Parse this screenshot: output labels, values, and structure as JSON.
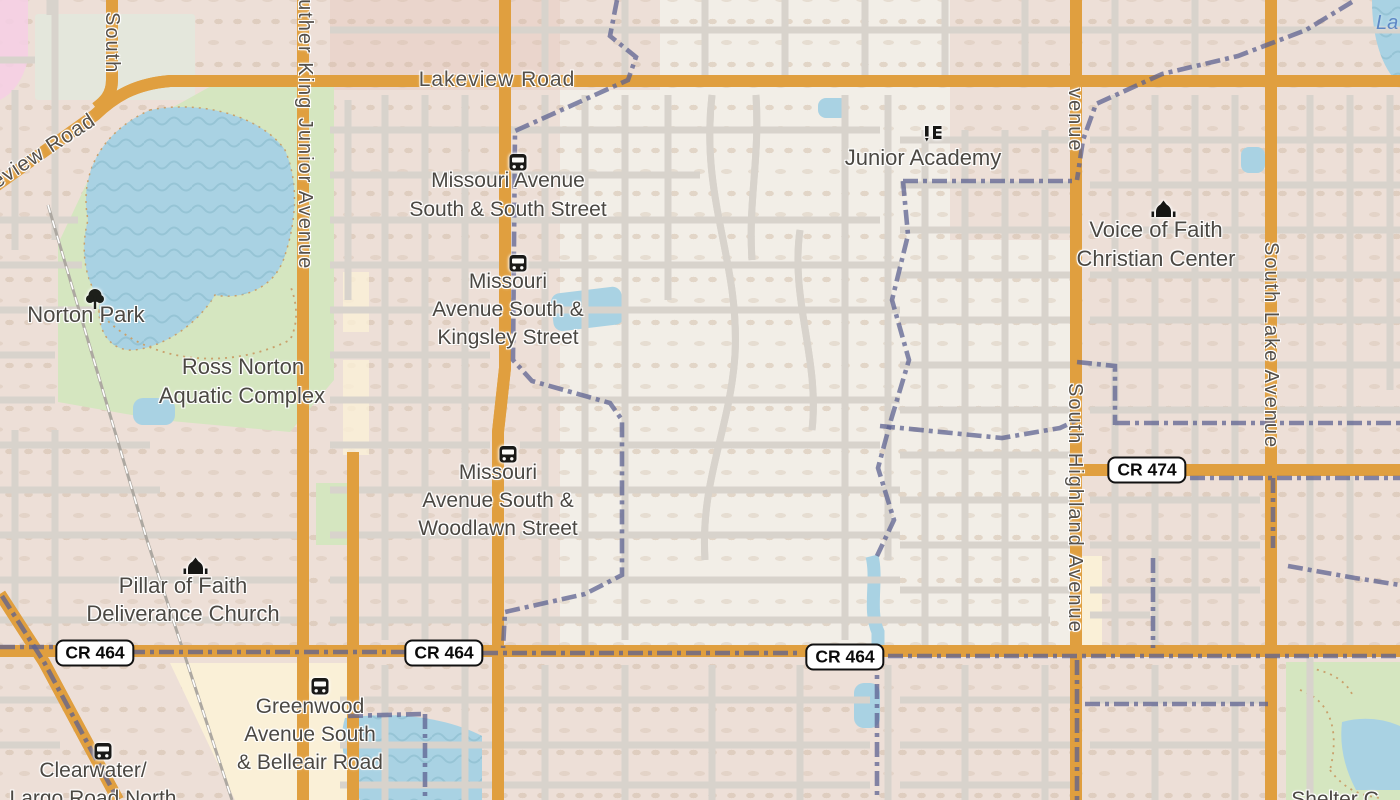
{
  "map_type": "street-map",
  "colors": {
    "land": "#F2EEE7",
    "water": "#A9D2E3",
    "park": "#D5E6C0",
    "grayland": "#E4E7DC",
    "commercial": "#FAF0D7",
    "road_fill": "#F5D971",
    "road_casing": "#E09F3F",
    "street": "#FFFFFF",
    "street_casing": "#D8D3CC",
    "boundary": "#5C6191",
    "rail": "#ADA8A1",
    "label": "#4B4843",
    "slabel": "#55504A",
    "water_label": "#5D87C5",
    "shield_bg": "#FFFFFF",
    "shield_border": "#111111"
  },
  "street_labels": [
    {
      "text": "Lakeview Road",
      "orientation": "horizontal"
    },
    {
      "text": "Lakeview Road",
      "orientation": "diagonal"
    },
    {
      "text": "South",
      "orientation": "vertical"
    },
    {
      "text": "Luther King Junior Avenue",
      "orientation": "vertical"
    },
    {
      "text": "venue",
      "orientation": "vertical"
    },
    {
      "text": "South Highland Avenue",
      "orientation": "vertical"
    },
    {
      "text": "South Lake Avenue",
      "orientation": "vertical"
    }
  ],
  "shields": [
    {
      "text": "CR 464"
    },
    {
      "text": "CR 464"
    },
    {
      "text": "CR 464"
    },
    {
      "text": "CR 474"
    }
  ],
  "bus_stops": [
    {
      "icon": "bus",
      "lines": [
        "Missouri Avenue",
        "South & South Street"
      ]
    },
    {
      "icon": "bus",
      "lines": [
        "Missouri",
        "Avenue South &",
        "Kingsley Street"
      ]
    },
    {
      "icon": "bus",
      "lines": [
        "Missouri",
        "Avenue South &",
        "Woodlawn Street"
      ]
    },
    {
      "icon": "bus",
      "lines": [
        "Greenwood",
        "Avenue South",
        "& Belleair Road"
      ]
    },
    {
      "icon": "bus",
      "lines": [
        "Clearwater/",
        "Largo Road North"
      ]
    }
  ],
  "poi_labels": [
    {
      "icon": "tree",
      "lines": [
        "Norton Park"
      ]
    },
    {
      "lines": [
        "Ross Norton",
        "Aquatic Complex"
      ]
    },
    {
      "icon": "school",
      "lines": [
        "Junior Academy"
      ]
    },
    {
      "icon": "place-of-worship",
      "lines": [
        "Voice of Faith",
        "Christian Center"
      ]
    },
    {
      "icon": "place-of-worship",
      "lines": [
        "Pillar of Faith",
        "Deliverance Church"
      ]
    },
    {
      "lines": [
        "Shelter C"
      ]
    }
  ],
  "water_labels": [
    {
      "text": "La"
    }
  ]
}
